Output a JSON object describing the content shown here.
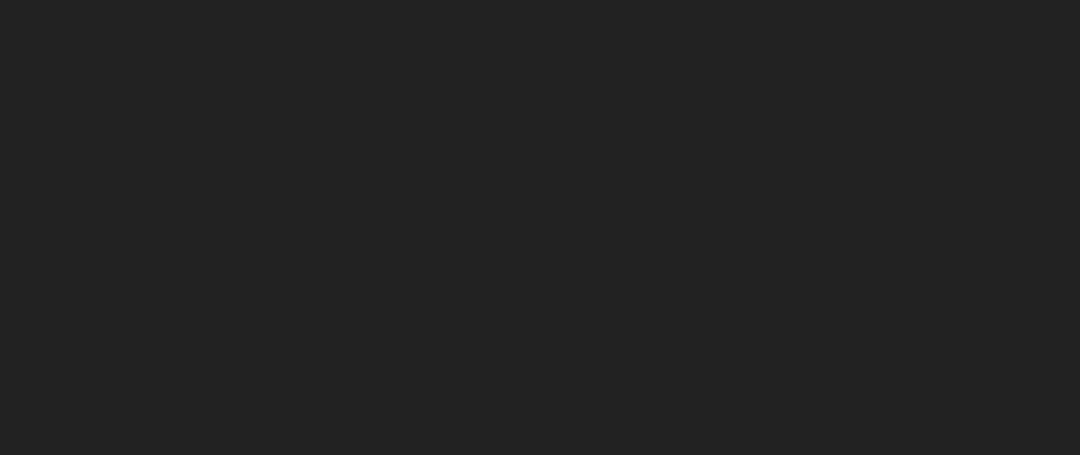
{
  "image": {
    "kind": "aerial architectural rendering",
    "subject": "biopharma innovation campus with river, roads and highlighted phase-2 plot"
  },
  "title": {
    "line1": "海派生命健康科创园二期项目-",
    "line2": "海派生物医药全域协同创新基地",
    "color": "#1b66f2",
    "outline_color": "#ffffff"
  },
  "boundary": {
    "color": "#0554f0"
  },
  "helipad": {
    "letter": "H",
    "color": "#3fae85"
  },
  "logos": {
    "building_logo_1": "HPNY",
    "building_logo_2": "HPNY"
  }
}
